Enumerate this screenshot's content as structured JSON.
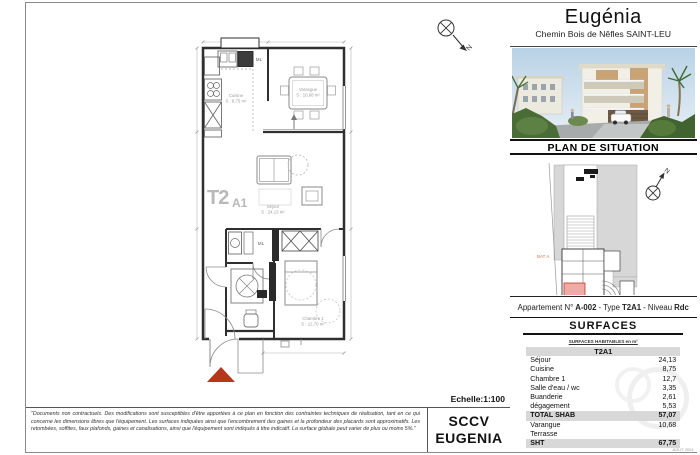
{
  "header": {
    "title": "Eugénia",
    "subtitle": "Chemin Bois de Nêfles SAINT-LEU"
  },
  "situation": {
    "title": "PLAN DE SITUATION",
    "bat_label": "BAT A",
    "north": "N"
  },
  "apartment": {
    "prefix": "Appartement N°",
    "number": "A-002",
    "sep1": "- Type",
    "type": "T2A1",
    "sep2": "- Niveau",
    "level": "Rdc"
  },
  "surfaces": {
    "title": "SURFACES",
    "note": "SURFACES HABITABLES en m²",
    "column": "T2A1",
    "rows": [
      {
        "label": "Séjour",
        "value": "24,13"
      },
      {
        "label": "Cuisine",
        "value": "8,75"
      },
      {
        "label": "Chambre 1",
        "value": "12,7"
      },
      {
        "label": "Salle d'eau / wc",
        "value": "3,35"
      },
      {
        "label": "Buanderie",
        "value": "2,61"
      },
      {
        "label": "dégagement",
        "value": "5,53"
      },
      {
        "label": "TOTAL SHAB",
        "value": "57,07"
      },
      {
        "label": "Varangue",
        "value": "10,68"
      },
      {
        "label": "Terrasse",
        "value": ""
      },
      {
        "label": "SHT",
        "value": "67,75"
      }
    ],
    "date_note": "AOUT 2024"
  },
  "plan": {
    "unit_main": "T2",
    "unit_sub": "A1",
    "ml_kitchen": "ML",
    "ml_laundry": "ML",
    "north": "N",
    "rooms": {
      "cuisine": "Cuisine",
      "cuisine_area": "S : 8,75 m²",
      "varangue": "Varangue",
      "varangue_area": "S : 10,68 m²",
      "sejour": "Séjour",
      "sejour_area": "S : 24,13 m²",
      "chambre": "Chambre 1",
      "chambre_area": "S : 12,70 m²"
    }
  },
  "footer": {
    "disclaimer": "\"Documents non contractuels. Des modifications sont susceptibles d'être apportées à ce plan en fonction des contraintes techniques de réalisation, tant en ce qui concerne les dimensions libres que l'équipement. Les surfaces indiquées ainsi que l'encombrement des gaines et la profondeur des placards sont approximatifs. Les retombées, soffites, faux plafonds, gaines et canalisations, ainsi que l'équipement sont indiqués à titre indicatif. La surface globale peut varier de plus ou moins 5%.\"",
    "scale": "Echelle:1:100",
    "company_line1": "SCCV",
    "company_line2": "EUGENIA"
  },
  "colors": {
    "accent_red": "#b5371c",
    "unit_pink": "#f0aaa6",
    "table_gray": "#d8d8d8"
  }
}
